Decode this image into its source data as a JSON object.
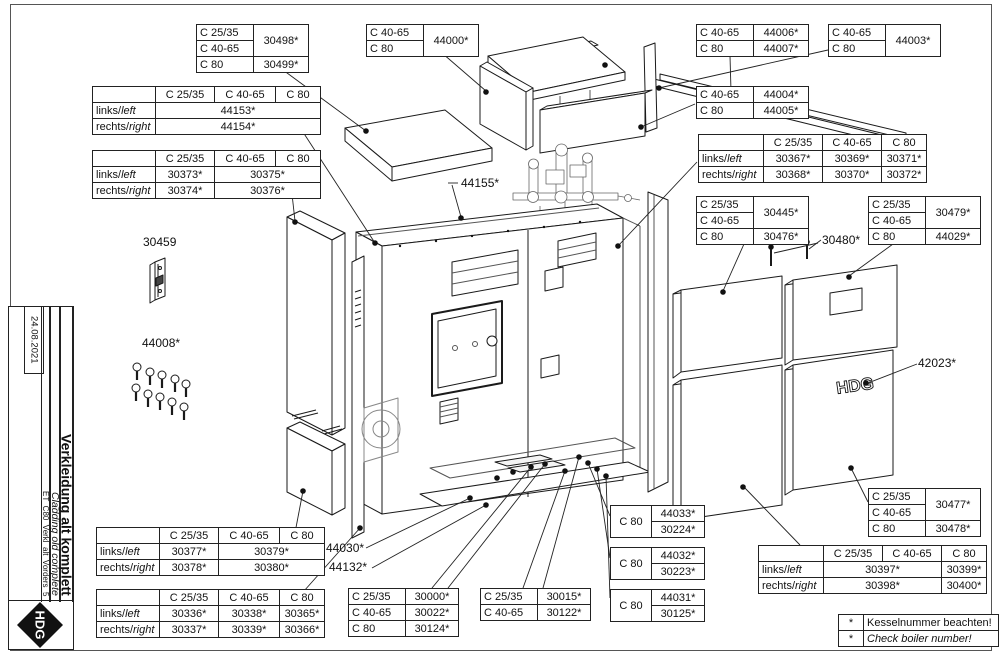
{
  "titleblock": {
    "date": "24.08.2021",
    "title_de": "Verkleidung alt komplett",
    "title_en": "Cladding old complete",
    "doc_code": "ET_C80_Verkl_alt_Vorders_5",
    "logo": "HDG"
  },
  "labels": {
    "p30459": "30459",
    "p44008": "44008*",
    "p44155": "44155*",
    "p44030": "44030*",
    "p44132": "44132*",
    "p30480": "30480*",
    "p42023": "42023*"
  },
  "tables": [
    {
      "key": "t30498",
      "cells": [
        [
          {
            "t": "C 25/35",
            "al": "l",
            "w": 50
          },
          {
            "t": "30498*",
            "rs": 2,
            "w": 48
          }
        ],
        [
          {
            "t": "C 40-65",
            "al": "l"
          }
        ],
        [
          {
            "t": "C 80",
            "al": "l"
          },
          {
            "t": "30499*"
          }
        ]
      ]
    },
    {
      "key": "t44153",
      "cells": [
        [
          {
            "t": "",
            "w": 56
          },
          {
            "t": "C 25/35",
            "w": 52
          },
          {
            "t": "C 40-65",
            "w": 54
          },
          {
            "t": "C 80",
            "w": 38
          }
        ],
        [
          {
            "t": "links/left",
            "dual": true,
            "al": "l"
          },
          {
            "t": "44153*",
            "cs": 3
          }
        ],
        [
          {
            "t": "rechts/right",
            "dual": true,
            "al": "l"
          },
          {
            "t": "44154*",
            "cs": 3
          }
        ]
      ]
    },
    {
      "key": "t30373",
      "cells": [
        [
          {
            "t": "",
            "w": 56
          },
          {
            "t": "C 25/35",
            "w": 52
          },
          {
            "t": "C 40-65",
            "w": 54
          },
          {
            "t": "C 80",
            "w": 38
          }
        ],
        [
          {
            "t": "links/left",
            "dual": true,
            "al": "l"
          },
          {
            "t": "30373*"
          },
          {
            "t": "30375*",
            "cs": 2
          }
        ],
        [
          {
            "t": "rechts/right",
            "dual": true,
            "al": "l"
          },
          {
            "t": "30374*"
          },
          {
            "t": "30376*",
            "cs": 2
          }
        ]
      ]
    },
    {
      "key": "t44000",
      "cells": [
        [
          {
            "t": "C 40-65",
            "al": "l",
            "w": 50
          },
          {
            "t": "44000*",
            "rs": 2,
            "w": 48
          }
        ],
        [
          {
            "t": "C 80",
            "al": "l"
          }
        ]
      ]
    },
    {
      "key": "t44006",
      "cells": [
        [
          {
            "t": "C 40-65",
            "al": "l",
            "w": 50
          },
          {
            "t": "44006*",
            "w": 48
          }
        ],
        [
          {
            "t": "C 80",
            "al": "l"
          },
          {
            "t": "44007*"
          }
        ]
      ]
    },
    {
      "key": "t44003",
      "cells": [
        [
          {
            "t": "C 40-65",
            "al": "l",
            "w": 50
          },
          {
            "t": "44003*",
            "rs": 2,
            "w": 48
          }
        ],
        [
          {
            "t": "C 80",
            "al": "l"
          }
        ]
      ]
    },
    {
      "key": "t44004",
      "cells": [
        [
          {
            "t": "C 40-65",
            "al": "l",
            "w": 50
          },
          {
            "t": "44004*",
            "w": 48
          }
        ],
        [
          {
            "t": "C 80",
            "al": "l"
          },
          {
            "t": "44005*"
          }
        ]
      ]
    },
    {
      "key": "t30367",
      "cells": [
        [
          {
            "t": "",
            "w": 58
          },
          {
            "t": "C 25/35",
            "w": 52
          },
          {
            "t": "C 40-65",
            "w": 52
          },
          {
            "t": "C 80",
            "w": 38
          }
        ],
        [
          {
            "t": "links/left",
            "dual": true,
            "al": "l"
          },
          {
            "t": "30367*"
          },
          {
            "t": "30369*"
          },
          {
            "t": "30371*"
          }
        ],
        [
          {
            "t": "rechts/right",
            "dual": true,
            "al": "l"
          },
          {
            "t": "30368*"
          },
          {
            "t": "30370*"
          },
          {
            "t": "30372*"
          }
        ]
      ]
    },
    {
      "key": "t30445",
      "cells": [
        [
          {
            "t": "C 25/35",
            "al": "l",
            "w": 50
          },
          {
            "t": "30445*",
            "rs": 2,
            "w": 48
          }
        ],
        [
          {
            "t": "C 40-65",
            "al": "l"
          }
        ],
        [
          {
            "t": "C 80",
            "al": "l"
          },
          {
            "t": "30476*"
          }
        ]
      ]
    },
    {
      "key": "t30479",
      "cells": [
        [
          {
            "t": "C 25/35",
            "al": "l",
            "w": 50
          },
          {
            "t": "30479*",
            "rs": 2,
            "w": 48
          }
        ],
        [
          {
            "t": "C 40-65",
            "al": "l"
          }
        ],
        [
          {
            "t": "C 80",
            "al": "l"
          },
          {
            "t": "44029*"
          }
        ]
      ]
    },
    {
      "key": "t30477",
      "cells": [
        [
          {
            "t": "C 25/35",
            "al": "l",
            "w": 50
          },
          {
            "t": "30477*",
            "rs": 2,
            "w": 48
          }
        ],
        [
          {
            "t": "C 40-65",
            "al": "l"
          }
        ],
        [
          {
            "t": "C 80",
            "al": "l"
          },
          {
            "t": "30478*"
          }
        ]
      ]
    },
    {
      "key": "t30397",
      "cells": [
        [
          {
            "t": "",
            "w": 58
          },
          {
            "t": "C 25/35",
            "w": 52
          },
          {
            "t": "C 40-65",
            "w": 52
          },
          {
            "t": "C 80",
            "w": 38
          }
        ],
        [
          {
            "t": "links/left",
            "dual": true,
            "al": "l"
          },
          {
            "t": "30397*",
            "cs": 2
          },
          {
            "t": "30399*"
          }
        ],
        [
          {
            "t": "rechts/right",
            "dual": true,
            "al": "l"
          },
          {
            "t": "30398*",
            "cs": 2
          },
          {
            "t": "30400*"
          }
        ]
      ]
    },
    {
      "key": "t30377",
      "cells": [
        [
          {
            "t": "",
            "w": 56
          },
          {
            "t": "C 25/35",
            "w": 52
          },
          {
            "t": "C 40-65",
            "w": 54
          },
          {
            "t": "C 80",
            "w": 38
          }
        ],
        [
          {
            "t": "links/left",
            "dual": true,
            "al": "l"
          },
          {
            "t": "30377*"
          },
          {
            "t": "30379*",
            "cs": 2
          }
        ],
        [
          {
            "t": "rechts/right",
            "dual": true,
            "al": "l"
          },
          {
            "t": "30378*"
          },
          {
            "t": "30380*",
            "cs": 2
          }
        ]
      ]
    },
    {
      "key": "t30336",
      "cells": [
        [
          {
            "t": "",
            "w": 56
          },
          {
            "t": "C 25/35",
            "w": 52
          },
          {
            "t": "C 40-65",
            "w": 54
          },
          {
            "t": "C 80",
            "w": 38
          }
        ],
        [
          {
            "t": "links/left",
            "dual": true,
            "al": "l"
          },
          {
            "t": "30336*"
          },
          {
            "t": "30338*"
          },
          {
            "t": "30365*"
          }
        ],
        [
          {
            "t": "rechts/right",
            "dual": true,
            "al": "l"
          },
          {
            "t": "30337*"
          },
          {
            "t": "30339*"
          },
          {
            "t": "30366*"
          }
        ]
      ]
    },
    {
      "key": "t30000",
      "cells": [
        [
          {
            "t": "C 25/35",
            "al": "l",
            "w": 50
          },
          {
            "t": "30000*",
            "w": 46
          }
        ],
        [
          {
            "t": "C 40-65",
            "al": "l"
          },
          {
            "t": "30022*"
          }
        ],
        [
          {
            "t": "C 80",
            "al": "l"
          },
          {
            "t": "30124*"
          }
        ]
      ]
    },
    {
      "key": "t30015",
      "cells": [
        [
          {
            "t": "C 25/35",
            "al": "l",
            "w": 50
          },
          {
            "t": "30015*",
            "w": 46
          }
        ],
        [
          {
            "t": "C 40-65",
            "al": "l"
          },
          {
            "t": "30122*"
          }
        ]
      ]
    },
    {
      "key": "t44033",
      "cells": [
        [
          {
            "t": "C 80",
            "rs": 2,
            "w": 34
          },
          {
            "t": "44033*",
            "w": 46
          }
        ],
        [
          {
            "t": "30224*"
          }
        ]
      ]
    },
    {
      "key": "t44032",
      "cells": [
        [
          {
            "t": "C 80",
            "rs": 2,
            "w": 34
          },
          {
            "t": "44032*",
            "w": 46
          }
        ],
        [
          {
            "t": "30223*"
          }
        ]
      ]
    },
    {
      "key": "t44031",
      "cells": [
        [
          {
            "t": "C 80",
            "rs": 2,
            "w": 34
          },
          {
            "t": "44031*",
            "w": 46
          }
        ],
        [
          {
            "t": "30125*"
          }
        ]
      ]
    },
    {
      "key": "notes",
      "cells": [
        [
          {
            "t": "*",
            "w": 18
          },
          {
            "t": "Kesselnummer beachten!",
            "al": "l",
            "w": 128
          }
        ],
        [
          {
            "t": "*"
          },
          {
            "t": "Check boiler number!",
            "i": true,
            "al": "l"
          }
        ]
      ]
    }
  ]
}
